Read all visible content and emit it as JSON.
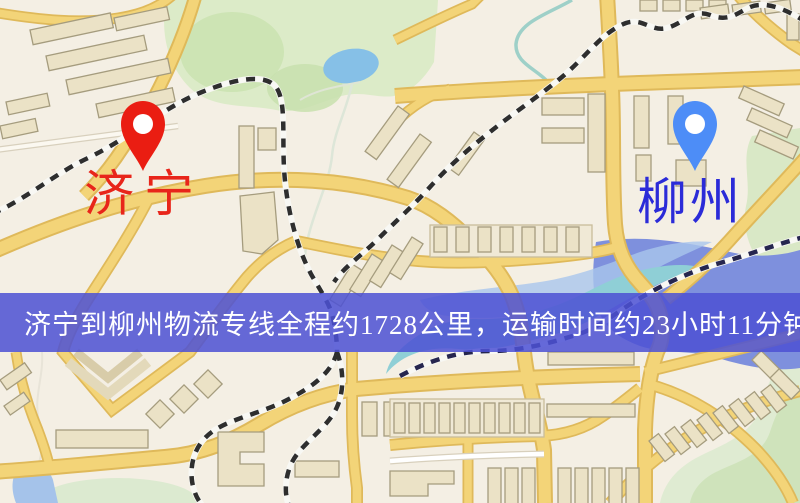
{
  "map": {
    "origin_marker": {
      "label": "济宁",
      "pin_color": "#ea1d12",
      "label_color": "#e8251a",
      "pin_style": "red-teardrop-marker"
    },
    "destination_marker": {
      "label": "柳州",
      "pin_color": "#4d8df7",
      "label_color": "#2b2bd8",
      "pin_style": "blue-teardrop-marker"
    },
    "banner": {
      "text": "济宁到柳州物流专线全程约1728公里，运输时间约23小时11分钟.",
      "background_color": "#4d51d4",
      "text_color": "#ffffff"
    },
    "route_facts": {
      "distance": "约1728公里",
      "duration": "约23小时11分钟"
    }
  }
}
